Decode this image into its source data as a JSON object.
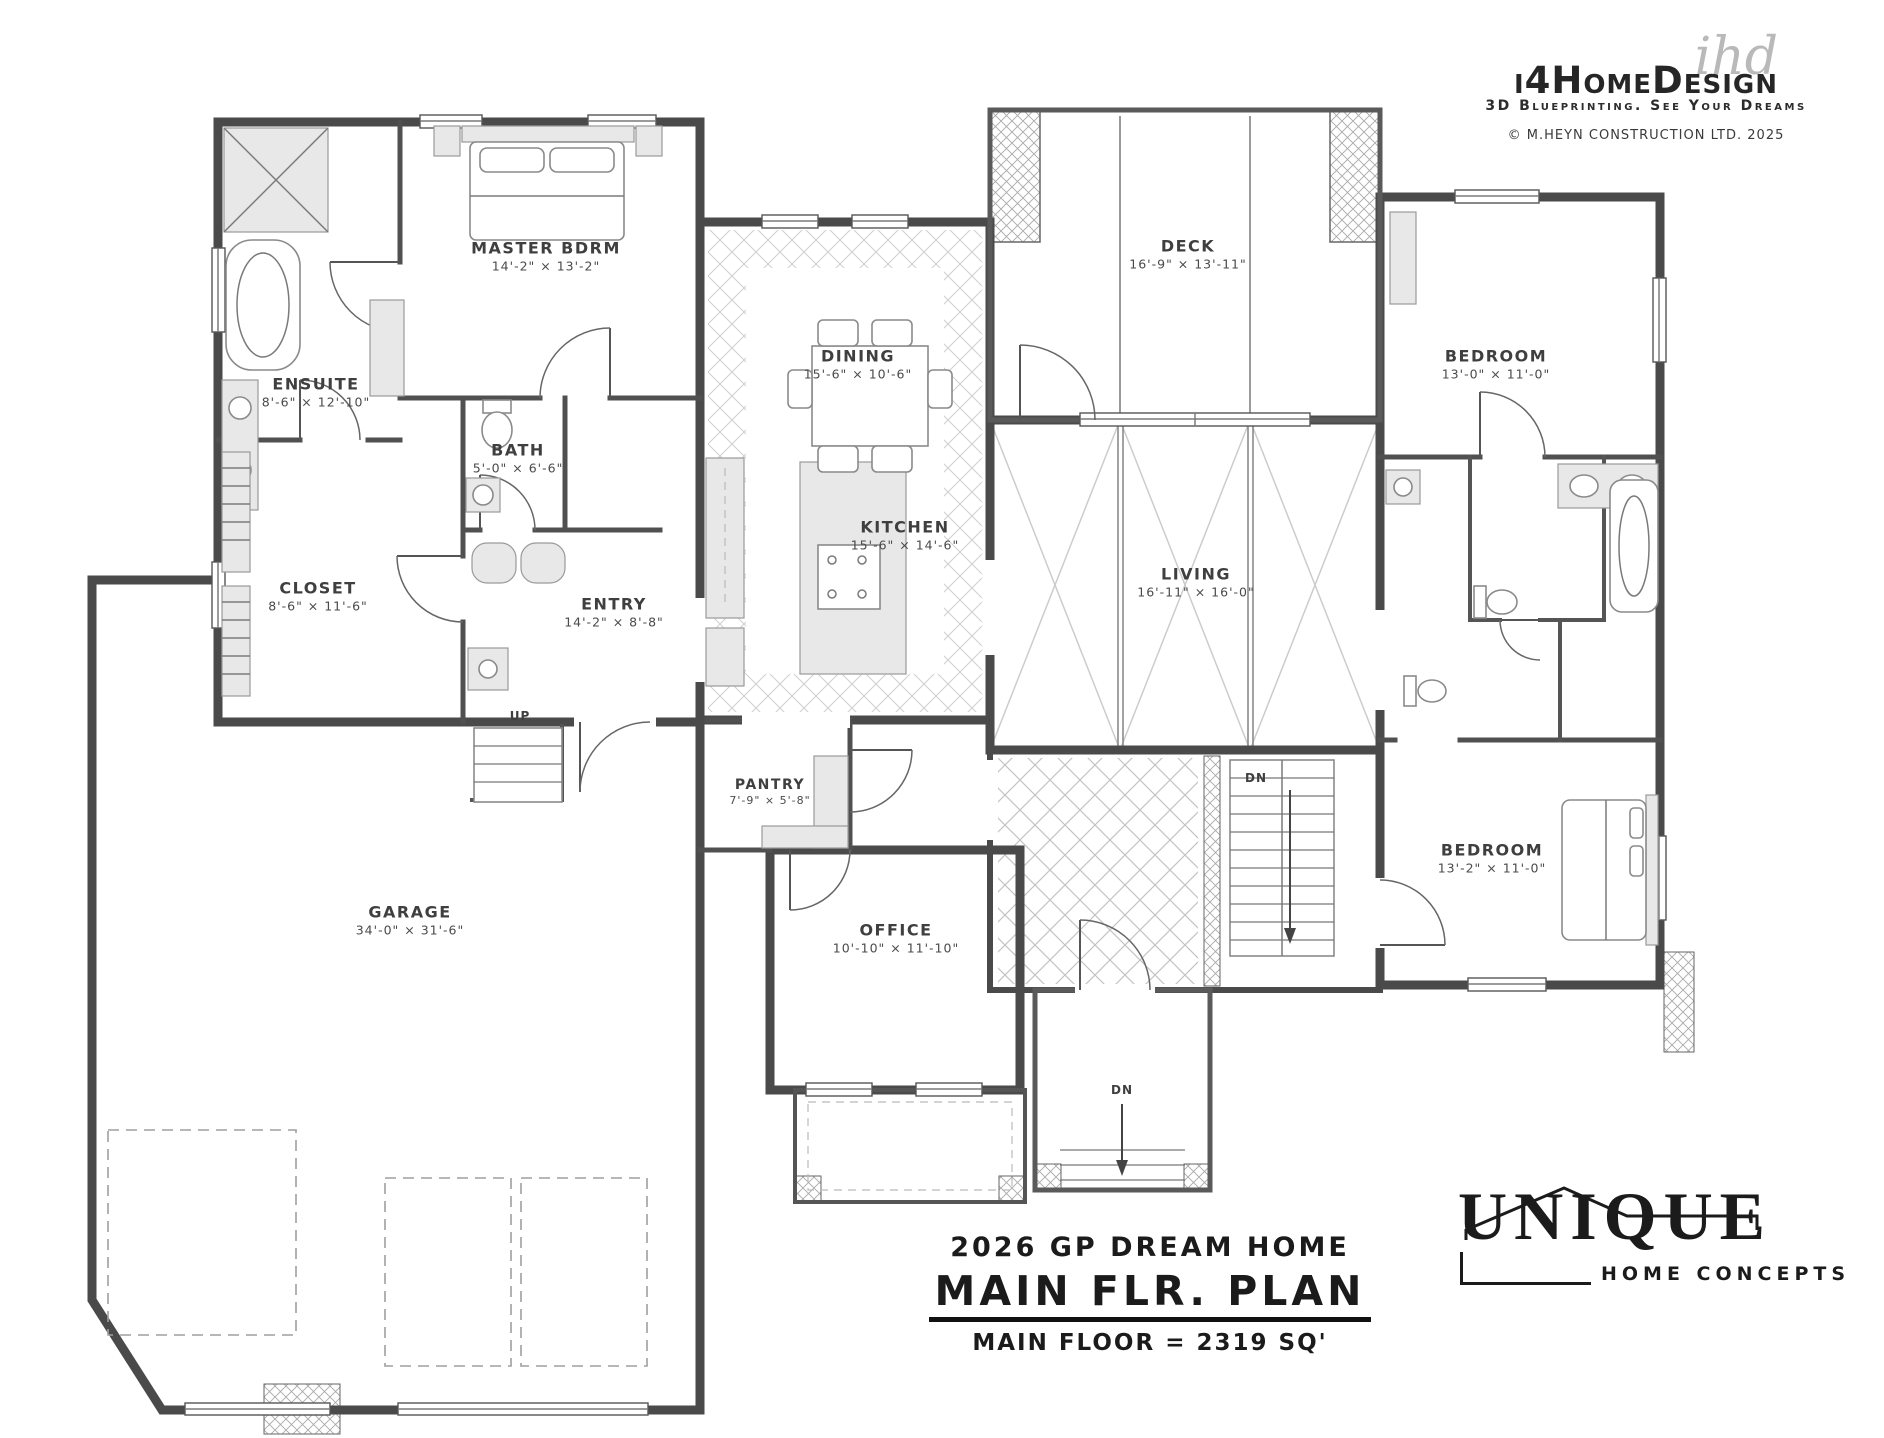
{
  "branding": {
    "script": "ihd",
    "name": "i4HomeDesign",
    "tagline": "3D Blueprinting. See Your Dreams",
    "copyright": "© M.HEYN CONSTRUCTION LTD. 2025"
  },
  "title_block": {
    "project": "2026 GP DREAM HOME",
    "sheet": "MAIN FLR. PLAN",
    "area": "MAIN FLOOR = 2319 SQ'"
  },
  "builder": {
    "name": "UNIQUE",
    "tagline": "HOME CONCEPTS"
  },
  "rooms": [
    {
      "name": "MASTER BDRM",
      "dims": "14'-2\" × 13'-2\""
    },
    {
      "name": "ENSUITE",
      "dims": "8'-6\" × 12'-10\""
    },
    {
      "name": "BATH",
      "dims": "5'-0\" × 6'-6\""
    },
    {
      "name": "CLOSET",
      "dims": "8'-6\" × 11'-6\""
    },
    {
      "name": "ENTRY",
      "dims": "14'-2\" × 8'-8\""
    },
    {
      "name": "DINING",
      "dims": "15'-6\" × 10'-6\""
    },
    {
      "name": "KITCHEN",
      "dims": "15'-6\" × 14'-6\""
    },
    {
      "name": "DECK",
      "dims": "16'-9\" × 13'-11\""
    },
    {
      "name": "LIVING",
      "dims": "16'-11\" × 16'-0\""
    },
    {
      "name": "BEDROOM",
      "dims": "13'-0\" × 11'-0\""
    },
    {
      "name": "BEDROOM",
      "dims": "13'-2\" × 11'-0\""
    },
    {
      "name": "PANTRY",
      "dims": "7'-9\" × 5'-8\""
    },
    {
      "name": "GARAGE",
      "dims": "34'-0\" × 31'-6\""
    },
    {
      "name": "OFFICE",
      "dims": "10'-10\" × 11'-10\""
    }
  ],
  "stairs": {
    "up": "UP",
    "down": "DN"
  }
}
